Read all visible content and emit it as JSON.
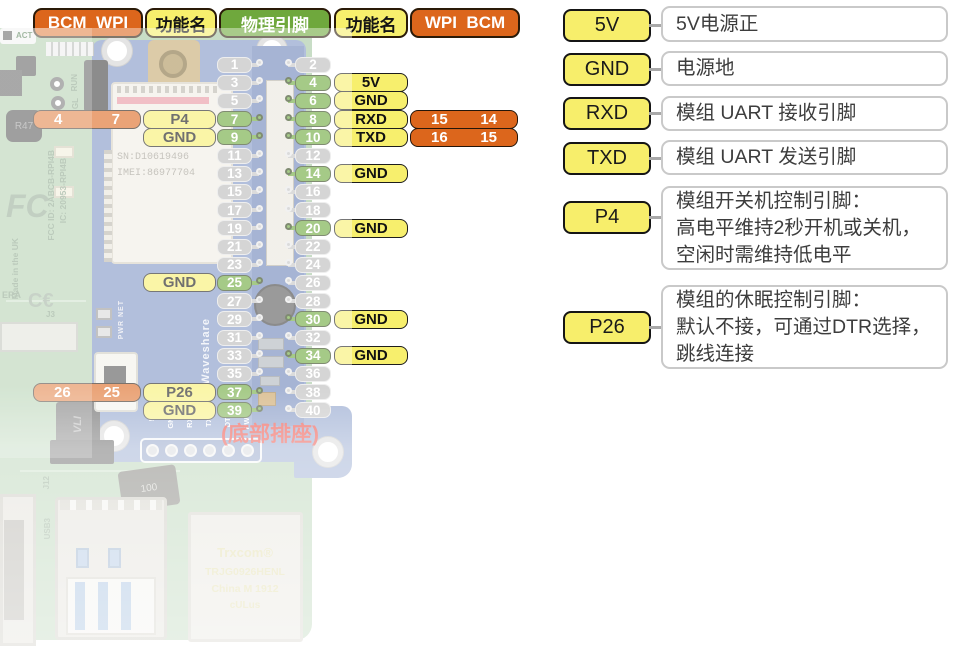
{
  "colors": {
    "orange": "#dc661c",
    "yellow": "#f7ef6d",
    "green": "#69a637",
    "gray_pin": "#b9b9b9",
    "red_note": "#e7271c"
  },
  "header": {
    "left_bcm_wpi": "BCM  WPI",
    "left_func": "功能名",
    "physical": "物理引脚",
    "right_func": "功能名",
    "right_wpi_bcm": "WPI  BCM"
  },
  "note": "(底部排座)",
  "pins": {
    "rows": [
      {
        "left": {
          "num": "1"
        },
        "right": {
          "num": "2"
        }
      },
      {
        "left": {
          "num": "3"
        },
        "right": {
          "num": "4",
          "green": true,
          "func": "5V"
        }
      },
      {
        "left": {
          "num": "5"
        },
        "right": {
          "num": "6",
          "green": true,
          "func": "GND"
        }
      },
      {
        "left": {
          "num": "7",
          "green": true,
          "func": "P4",
          "bcm": "4",
          "wpi": "7"
        },
        "right": {
          "num": "8",
          "green": true,
          "func": "RXD",
          "wpi": "15",
          "bcm": "14"
        }
      },
      {
        "left": {
          "num": "9",
          "green": true,
          "func": "GND"
        },
        "right": {
          "num": "10",
          "green": true,
          "func": "TXD",
          "wpi": "16",
          "bcm": "15"
        }
      },
      {
        "left": {
          "num": "11"
        },
        "right": {
          "num": "12"
        }
      },
      {
        "left": {
          "num": "13"
        },
        "right": {
          "num": "14",
          "green": true,
          "func": "GND"
        }
      },
      {
        "left": {
          "num": "15"
        },
        "right": {
          "num": "16"
        }
      },
      {
        "left": {
          "num": "17"
        },
        "right": {
          "num": "18"
        }
      },
      {
        "left": {
          "num": "19"
        },
        "right": {
          "num": "20",
          "green": true,
          "func": "GND"
        }
      },
      {
        "left": {
          "num": "21"
        },
        "right": {
          "num": "22"
        }
      },
      {
        "left": {
          "num": "23"
        },
        "right": {
          "num": "24"
        }
      },
      {
        "left": {
          "num": "25",
          "green": true,
          "func": "GND"
        },
        "right": {
          "num": "26"
        }
      },
      {
        "left": {
          "num": "27"
        },
        "right": {
          "num": "28"
        }
      },
      {
        "left": {
          "num": "29"
        },
        "right": {
          "num": "30",
          "green": true,
          "func": "GND"
        }
      },
      {
        "left": {
          "num": "31"
        },
        "right": {
          "num": "32"
        }
      },
      {
        "left": {
          "num": "33"
        },
        "right": {
          "num": "34",
          "green": true,
          "func": "GND"
        }
      },
      {
        "left": {
          "num": "35"
        },
        "right": {
          "num": "36"
        }
      },
      {
        "left": {
          "num": "37",
          "green": true,
          "func": "P26",
          "bcm": "26",
          "wpi": "25"
        },
        "right": {
          "num": "38"
        }
      },
      {
        "left": {
          "num": "39",
          "green": true,
          "func": "GND"
        },
        "right": {
          "num": "40"
        }
      }
    ]
  },
  "legend": {
    "items": [
      {
        "label": "5V",
        "desc": [
          "5V电源正"
        ]
      },
      {
        "label": "GND",
        "desc": [
          "电源地"
        ]
      },
      {
        "label": "RXD",
        "desc": [
          "模组 UART 接收引脚"
        ]
      },
      {
        "label": "TXD",
        "desc": [
          "模组 UART 发送引脚"
        ]
      },
      {
        "label": "P4",
        "desc": [
          "模组开关机控制引脚：",
          "高电平维持2秒开机或关机，",
          "空闲时需维持低电平"
        ]
      },
      {
        "label": "P26",
        "desc": [
          "模组的休眠控制引脚：",
          "默认不接，可通过DTR选择，",
          "跳线连接"
        ]
      }
    ]
  },
  "photo": {
    "act": "ACT",
    "run": "RUN",
    "gl": "GL",
    "r47": "R47",
    "fcc_mark": "FC",
    "fcc_id": "FCC ID: 2ABCB-RPI4B",
    "ic_id": "IC: 20953-RPI4B",
    "made_in": "Made in the UK",
    "ce_mark": "C€",
    "camera": "ERA",
    "j3": "J3",
    "j12": "J12",
    "usb3": "USB3",
    "sn": "SN:D10619496",
    "imei": "IMEI:86977704",
    "waveshare": "Waveshare",
    "pwr_net": "PWR NET",
    "vli": "VLI",
    "diode_mark": "100",
    "pads": [
      "5V",
      "GND",
      "RXD",
      "TXD",
      "DTR",
      "PWR"
    ],
    "eth": [
      "Trxcom®",
      "TRJG0926HENL",
      "China M 1912",
      "cULus"
    ]
  }
}
